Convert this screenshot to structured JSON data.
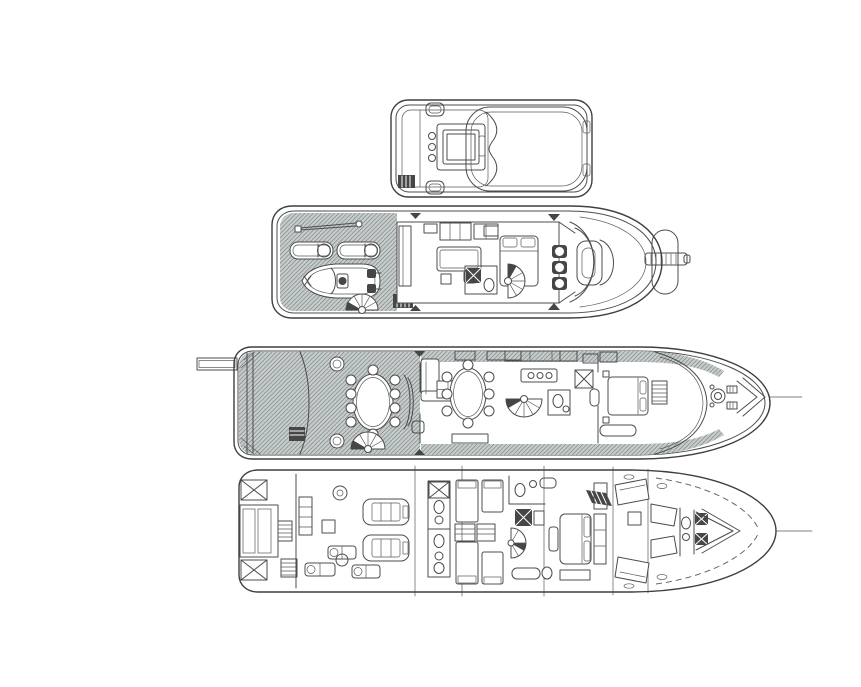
{
  "document": {
    "title": "yacht-general-arrangement-plan",
    "background": "#ffffff",
    "ink": "#4c4c4c",
    "dark_fill": "#464646",
    "teak_base": "#c6cbcb",
    "teak_line": "#6f7878",
    "deck_count": 4,
    "decks": [
      {
        "id": "sun-deck-top",
        "label": "sun-deck-top-view",
        "features": [
          "console-unit",
          "deck-hatch",
          "vent-grill",
          "hardtop-pad"
        ]
      },
      {
        "id": "bridge-deck",
        "label": "bridge-deck-plan",
        "features": [
          "crane-boom",
          "sun-pads",
          "tender-boat",
          "spiral-staircase",
          "skylounge-sofa",
          "berth",
          "helm-seats",
          "helm-console",
          "bow-pulpit",
          "bowsprit"
        ]
      },
      {
        "id": "main-deck",
        "label": "main-deck-plan",
        "features": [
          "passerelle",
          "swim-platform",
          "aft-dining-table",
          "spiral-staircase",
          "salon-sofa",
          "card-table",
          "dining-table",
          "galley-island",
          "day-head",
          "master-bed",
          "anchor-windlass",
          "bow-bulwark"
        ]
      },
      {
        "id": "lower-deck",
        "label": "lower-deck-plan",
        "features": [
          "lazarette-hatch",
          "garage",
          "generators",
          "main-engines",
          "guest-bathroom",
          "twin-beds",
          "dressers",
          "spiral-staircase",
          "vip-bed",
          "crew-bunks",
          "chain-locker"
        ]
      }
    ]
  }
}
